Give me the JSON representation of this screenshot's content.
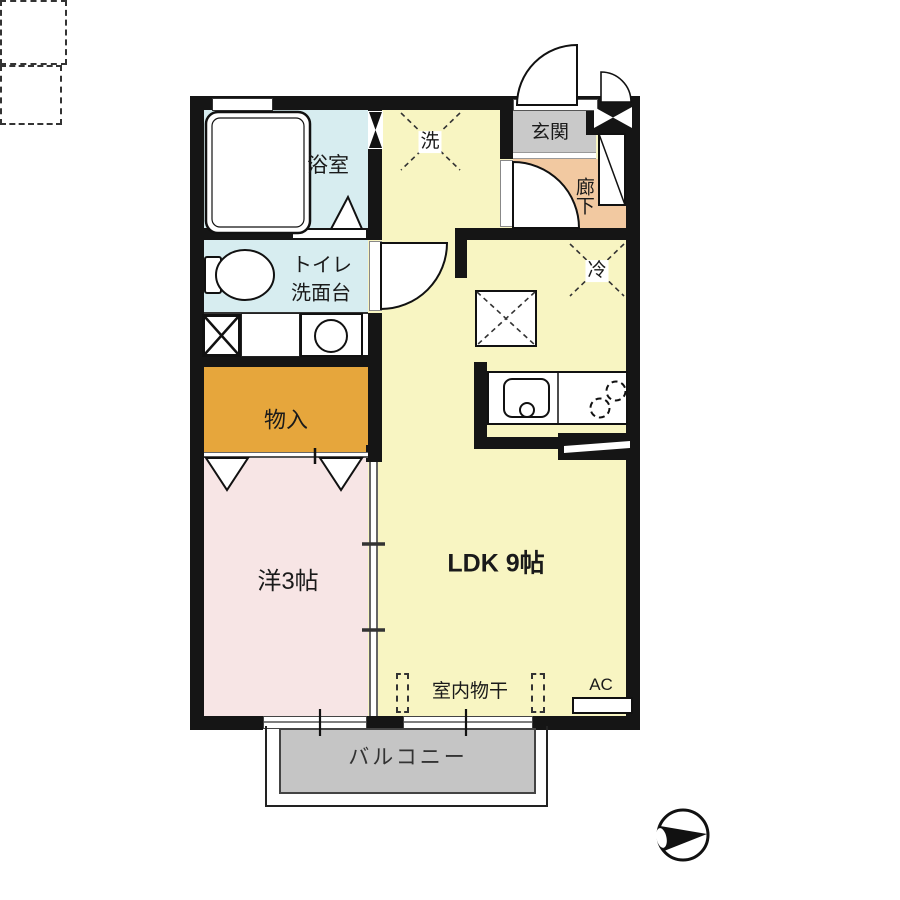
{
  "labels": {
    "bathroom": "浴室",
    "toilet": "トイレ",
    "washstand": "洗面台",
    "storage": "物入",
    "western_room": "洋3帖",
    "ldk": "LDK 9帖",
    "entrance": "玄関",
    "hallway": "廊下",
    "washer": "洗",
    "refrigerator": "冷",
    "indoor_drying": "室内物干",
    "air_conditioner": "AC",
    "balcony": "バルコニー"
  },
  "colors": {
    "wall": "#151515",
    "wet_area": "#d7edf0",
    "ldk": "#f8f5c2",
    "entrance": "#c9c9c9",
    "hallway": "#f2c9a1",
    "storage": "#e6a63c",
    "western_room": "#f7e5e5",
    "balcony": "#c5c5c5"
  },
  "icons": {
    "north_arrow": "black-triangle-in-circle-pointing-right"
  }
}
